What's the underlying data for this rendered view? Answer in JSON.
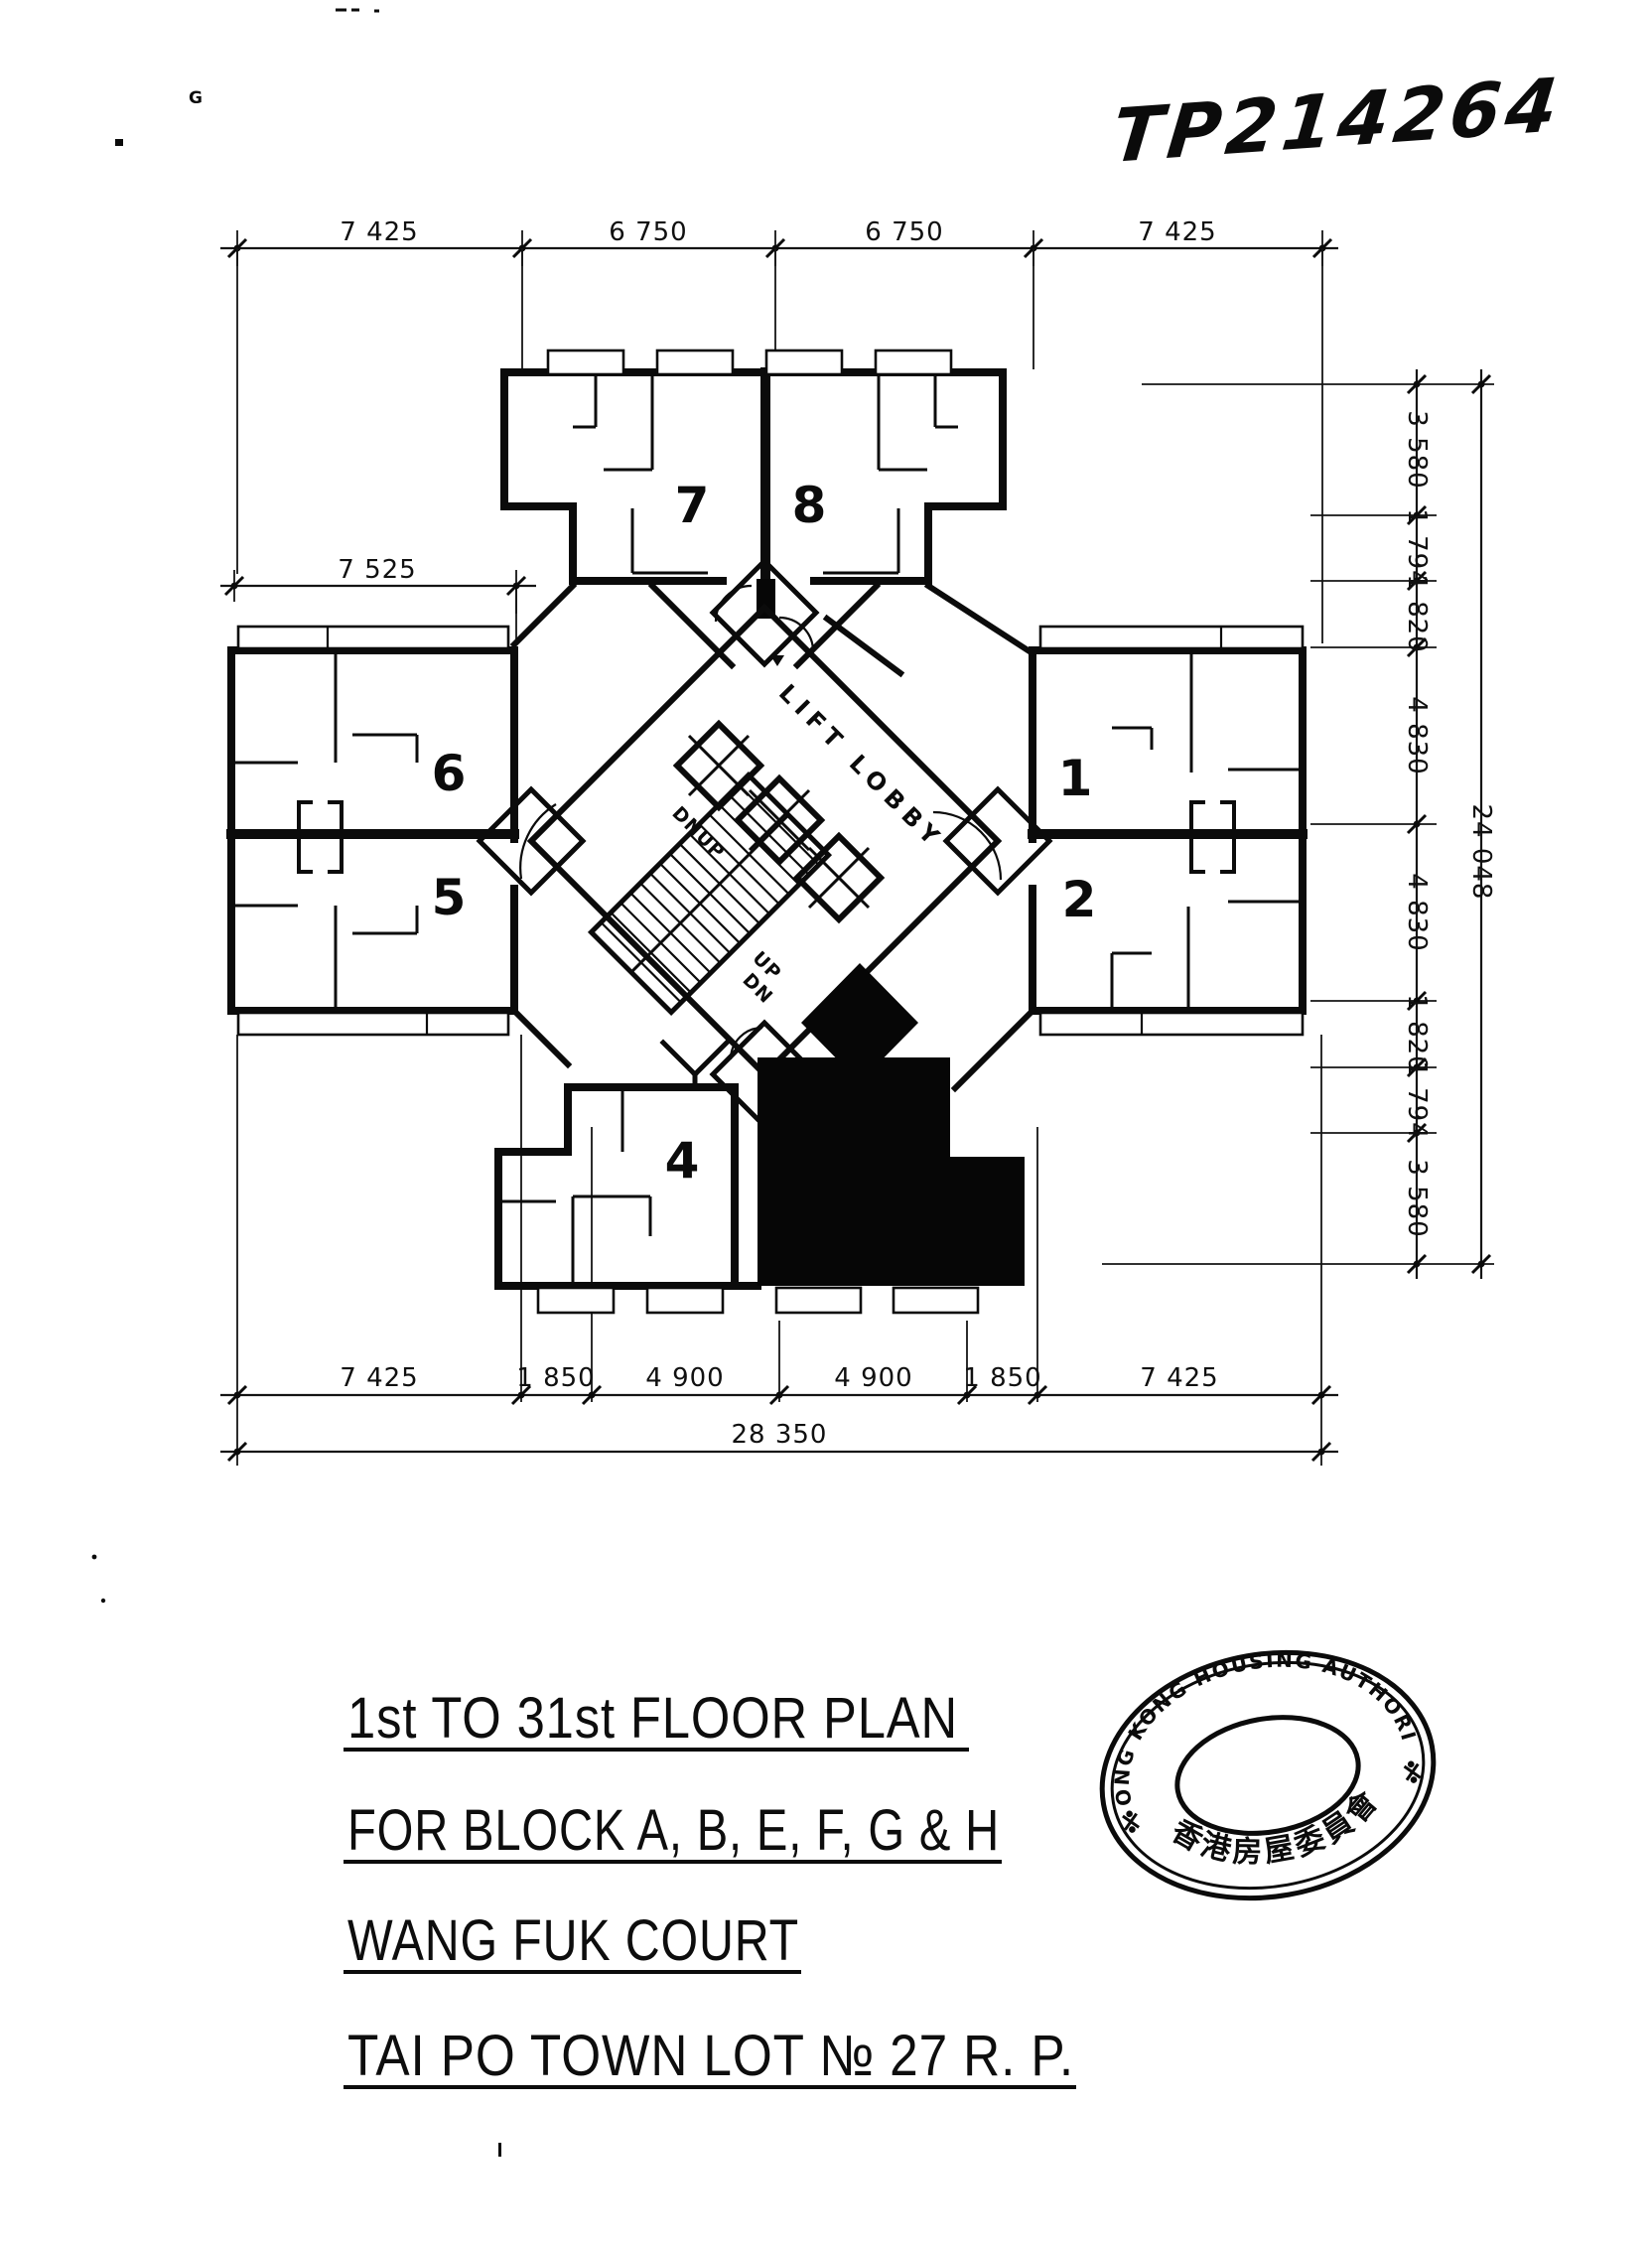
{
  "doc_ref": "TP214264",
  "artifacts": {
    "corner_letter": "G"
  },
  "plan": {
    "lift_lobby": "LIFT LOBBY",
    "stairs": {
      "upper_dn": "DN",
      "upper_up": "UP",
      "lower_up": "UP",
      "lower_dn": "DN"
    },
    "units": {
      "u1": "1",
      "u2": "2",
      "u4": "4",
      "u5": "5",
      "u6": "6",
      "u7": "7",
      "u8": "8"
    }
  },
  "dimensions": {
    "top": [
      "7 425",
      "6 750",
      "6 750",
      "7 425"
    ],
    "left_wing_width": "7 525",
    "right_chain": [
      "3 580",
      "1 794",
      "1 820",
      "4 830",
      "4 830",
      "1 820",
      "1 794",
      "3 580"
    ],
    "right_overall": "24 048",
    "bottom": [
      "7 425",
      "1 850",
      "4 900",
      "4 900",
      "1 850",
      "7 425"
    ],
    "bottom_overall": "28 350"
  },
  "title_block": {
    "line1": "1st TO 31st FLOOR PLAN",
    "line2": "FOR BLOCK A, B, E, F, G & H",
    "line3": "WANG FUK COURT",
    "line4": "TAI PO TOWN LOT № 27 R. P."
  },
  "stamp": {
    "arc_text": "HONG KONG HOUSING AUTHORITY",
    "chinese_text": "香港房屋委員會"
  }
}
